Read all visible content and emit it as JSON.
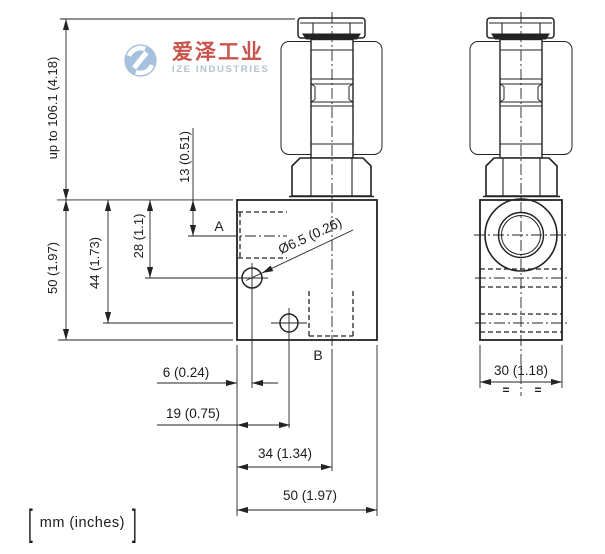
{
  "watermark": {
    "brand_cn": "爱泽工业",
    "brand_en": "IZE INDUSTRIES",
    "colors": {
      "logo": "#a6c1de",
      "cn": "#c9544a",
      "en": "#b3c2d1"
    }
  },
  "front_view": {
    "port_a_label": "A",
    "port_b_label": "B",
    "hole_diameter_label": "Ø6.5 (0.26)"
  },
  "side_view": {
    "width_label": "30 (1.18)",
    "symmetry_mark": "="
  },
  "dims": {
    "total_height": "up to 106.1 (4.18)",
    "body_height": "50 (1.97)",
    "hole_b_depth": "44 (1.73)",
    "hole_a_depth": "28 (1.1)",
    "port_a_axis": "13 (0.51)",
    "hole_a_offset": "6 (0.24)",
    "hole_b_offset": "19 (0.75)",
    "cartridge_axis_offset": "34 (1.34)",
    "body_width": "50 (1.97)"
  },
  "units_note": {
    "left_bracket": "[",
    "label": "mm (inches)",
    "right_bracket": "]"
  },
  "line_color": "#232323"
}
